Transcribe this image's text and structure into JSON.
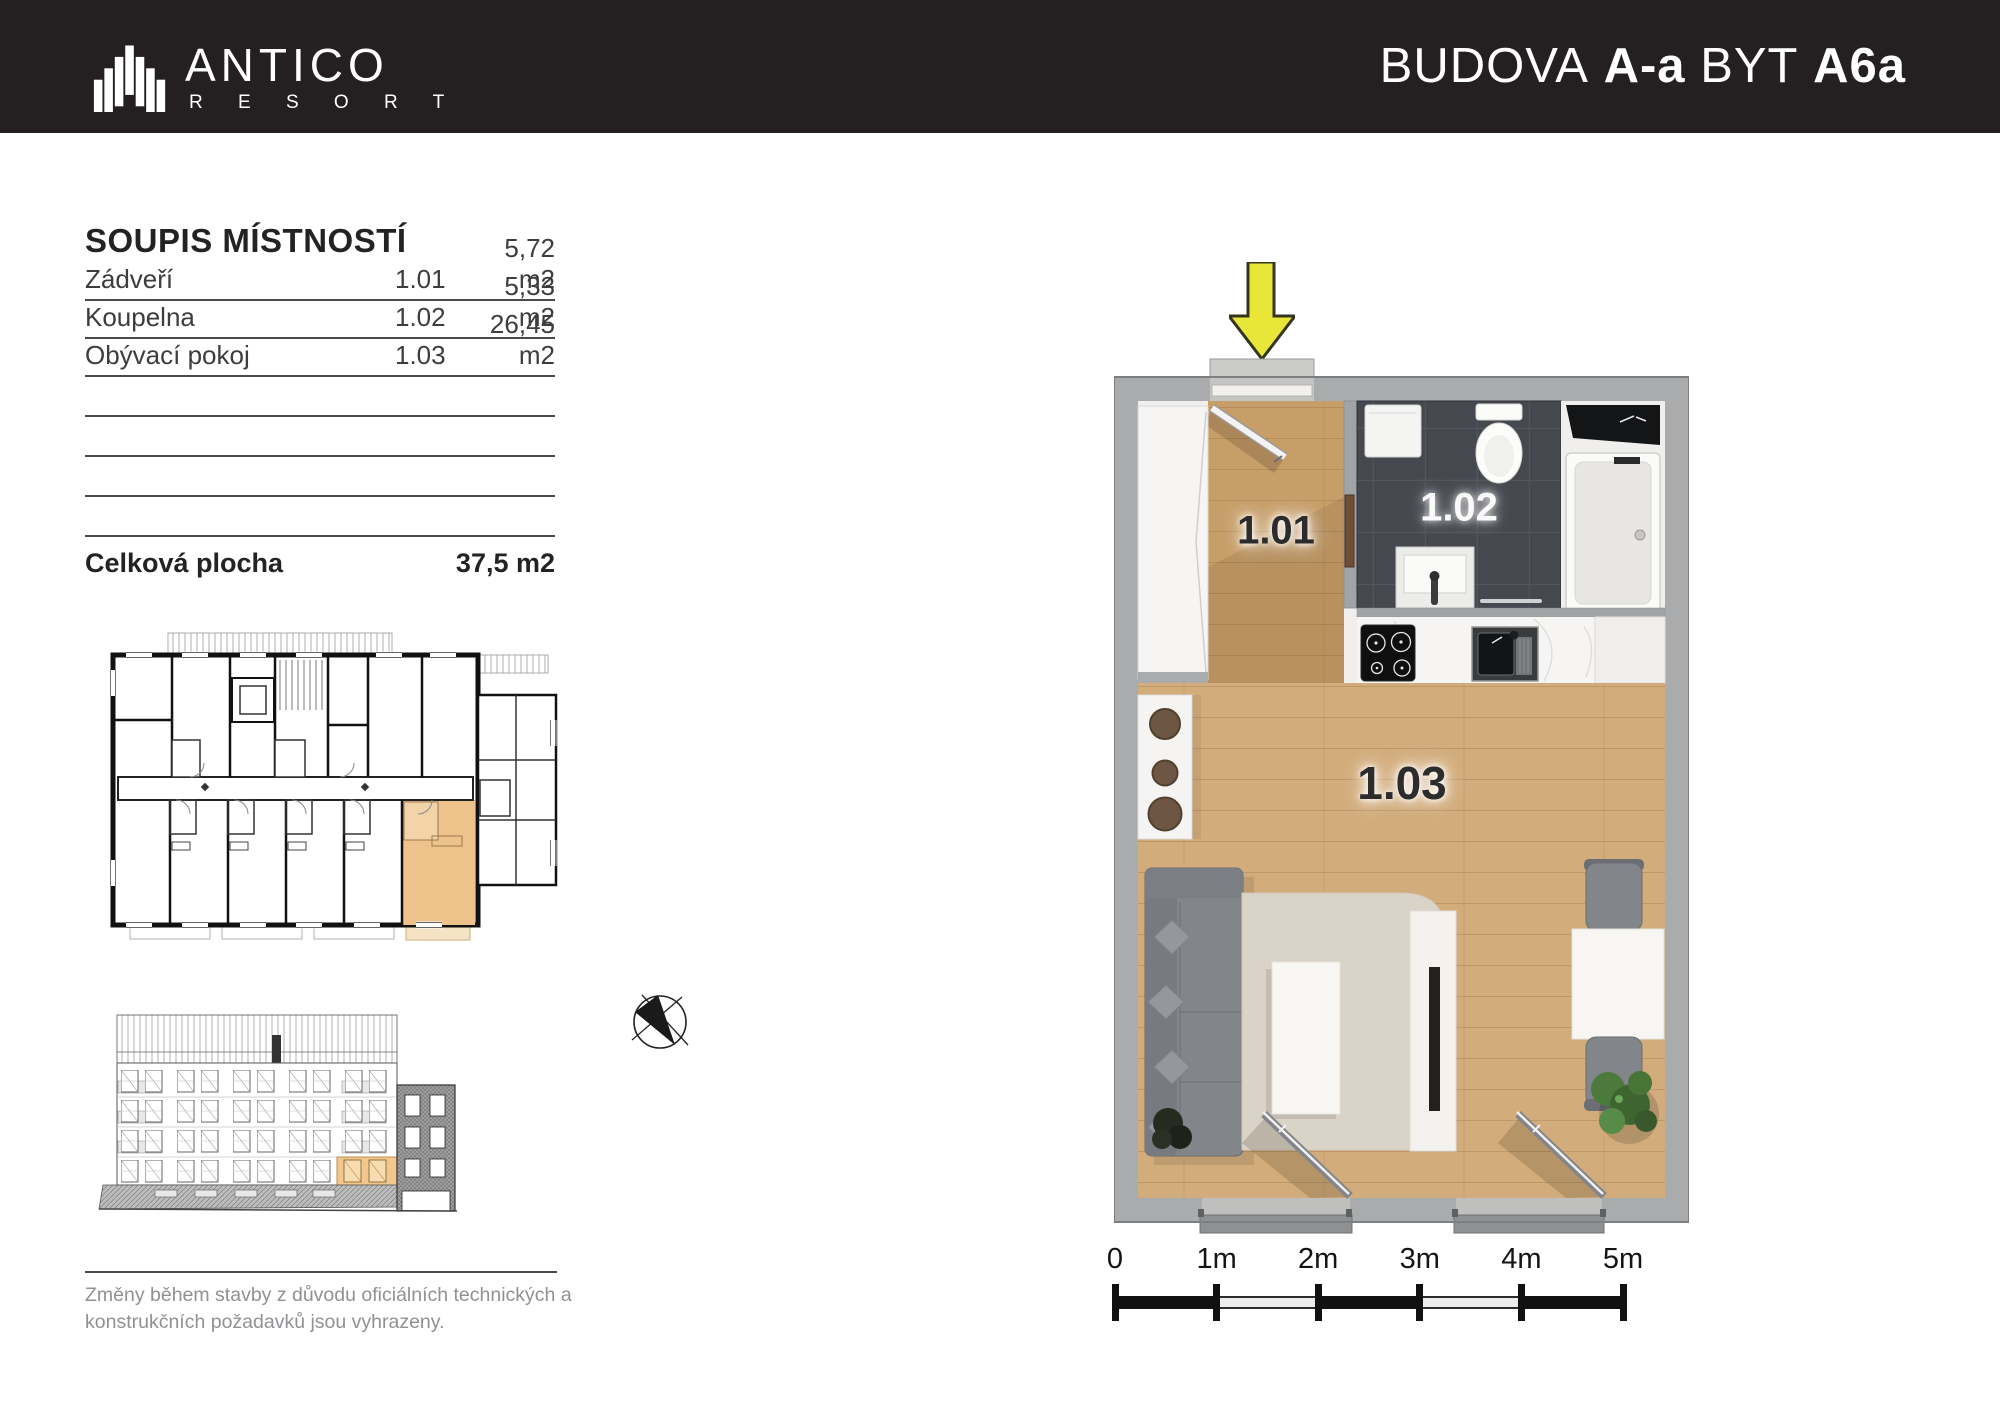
{
  "header": {
    "brand_name": "ANTICO",
    "brand_subtitle": "R E S O R T",
    "title": {
      "p1": "BUDOVA",
      "p2": "A-a",
      "p3": "BYT",
      "p4": "A6a"
    }
  },
  "room_table": {
    "title": "SOUPIS MÍSTNOSTÍ",
    "rows": [
      {
        "name": "Zádveří",
        "number": "1.01",
        "area": "5,72 m2"
      },
      {
        "name": "Koupelna",
        "number": "1.02",
        "area": "5,33 m2"
      },
      {
        "name": "Obývací pokoj",
        "number": "1.03",
        "area": "26,45 m2"
      }
    ],
    "empty_row_count": 4,
    "total_label": "Celková plocha",
    "total_area": "37,5 m2"
  },
  "plan": {
    "labels": [
      {
        "text": "1.01"
      },
      {
        "text": "1.02"
      },
      {
        "text": "1.03"
      }
    ]
  },
  "scale_bar": {
    "labels": [
      "0",
      "1m",
      "2m",
      "3m",
      "4m",
      "5m"
    ]
  },
  "disclaimer": {
    "line1": "Změny během stavby z důvodu oficiálních technických a",
    "line2": "konstrukčních požadavků jsou vyhrazeny."
  },
  "colors": {
    "header_bg": "#242021",
    "highlight_orange": "#eec28b",
    "arrow_yellow": "#e9e63a",
    "wood_floor": "#cda572",
    "bathroom_tile": "#45484f",
    "wall_gray": "#aaabad"
  }
}
